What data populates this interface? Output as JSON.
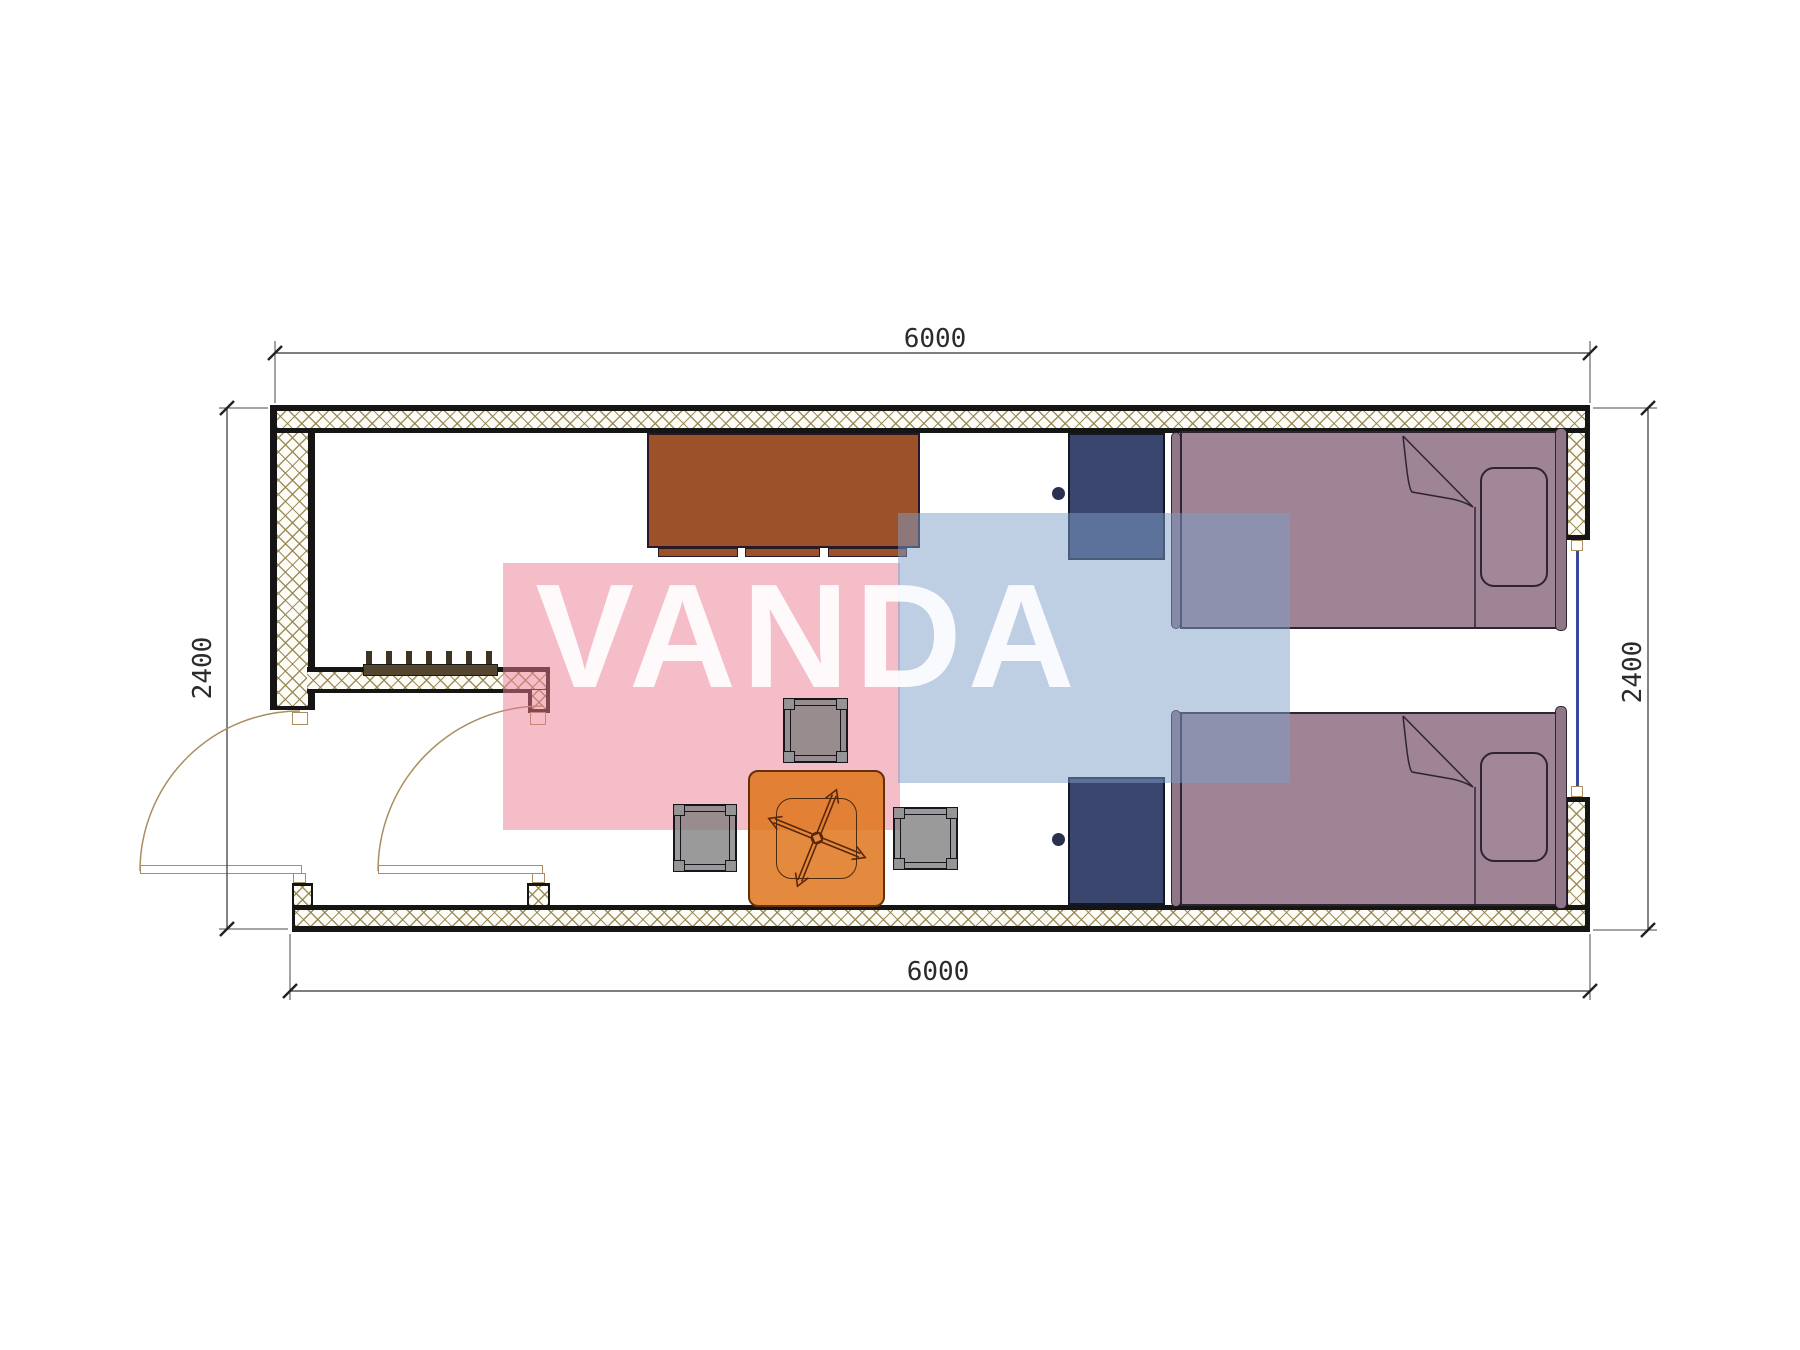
{
  "document": {
    "type": "floor-plan-drawing",
    "paper_color": "#ffffff"
  },
  "watermark": {
    "text": "VANDA",
    "pink_color": "#ec7c92",
    "blue_color": "#7d9ec7",
    "text_color": "#ffffff"
  },
  "dimensions": {
    "top": {
      "value": "6000"
    },
    "bottom": {
      "value": "6000"
    },
    "left": {
      "value": "2400"
    },
    "right": {
      "value": "2400"
    }
  },
  "plan": {
    "wall_line_color": "#151515",
    "wall_hatch_color": "#94844e",
    "window_glass_color": "#39499b",
    "door_arc_color": "#a98e5f",
    "furniture_colors": {
      "desk": "#9c5128",
      "wardrobe": "#3b466f",
      "bed": "#9e8495",
      "table": "#de761c",
      "stool": "#7d7d7d",
      "rack": "#54452f"
    },
    "furniture": [
      {
        "name": "desk"
      },
      {
        "name": "wardrobe-upper"
      },
      {
        "name": "wardrobe-lower"
      },
      {
        "name": "bed-upper"
      },
      {
        "name": "bed-lower"
      },
      {
        "name": "pillow-upper"
      },
      {
        "name": "pillow-lower"
      },
      {
        "name": "square-table"
      },
      {
        "name": "stool-top"
      },
      {
        "name": "stool-left"
      },
      {
        "name": "stool-right"
      },
      {
        "name": "shoe-rack"
      },
      {
        "name": "entry-door-left"
      },
      {
        "name": "entry-door-right"
      },
      {
        "name": "window-right"
      }
    ]
  }
}
